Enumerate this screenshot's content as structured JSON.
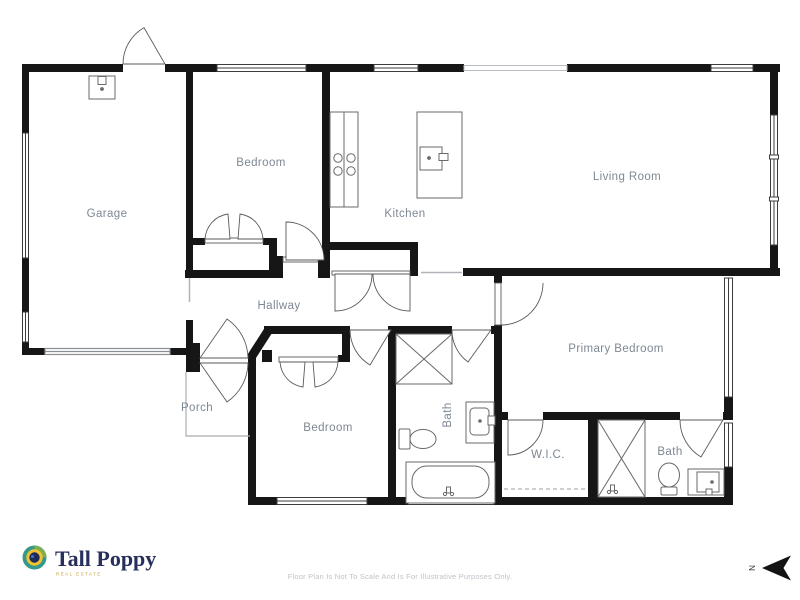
{
  "floorplan": {
    "rooms": [
      {
        "id": "garage",
        "label": "Garage"
      },
      {
        "id": "bedroom-1",
        "label": "Bedroom"
      },
      {
        "id": "kitchen",
        "label": "Kitchen"
      },
      {
        "id": "living-room",
        "label": "Living Room"
      },
      {
        "id": "hallway",
        "label": "Hallway"
      },
      {
        "id": "porch",
        "label": "Porch"
      },
      {
        "id": "bedroom-2",
        "label": "Bedroom"
      },
      {
        "id": "bath-1",
        "label": "Bath"
      },
      {
        "id": "primary-bedroom",
        "label": "Primary Bedroom"
      },
      {
        "id": "wic",
        "label": "W.I.C."
      },
      {
        "id": "bath-2",
        "label": "Bath"
      }
    ],
    "compass": {
      "direction_label": "N"
    },
    "branding": {
      "name": "Tall Poppy",
      "tagline": "REAL ESTATE",
      "brand_navy": "#27305c",
      "brand_gold": "#f1c232",
      "brand_teal": "#35998a"
    },
    "disclaimer": "Floor Plan Is Not To Scale And Is For Illustrative Purposes Only.",
    "colors": {
      "wall": "#161616",
      "room_label": "#7d8893",
      "window_outline": "#3c3c3c",
      "fixture": "#6a6a6a",
      "open_passage": "#b0b4ba",
      "disclaimer_text": "#bfc3c8"
    }
  }
}
